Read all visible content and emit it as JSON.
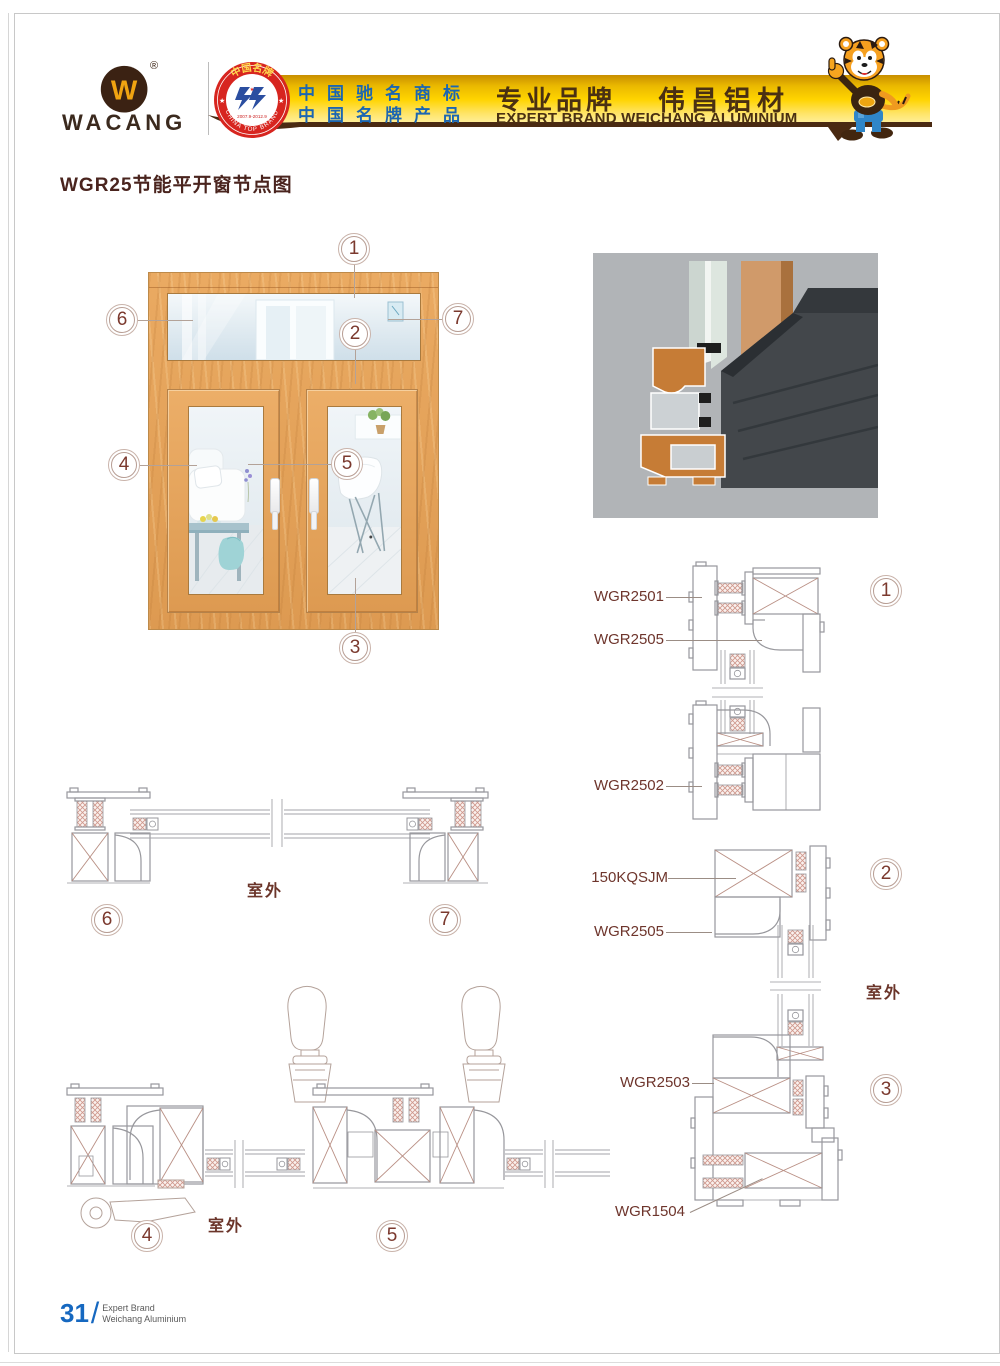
{
  "header": {
    "brand": "WACANG",
    "registered_mark": "®",
    "badge": {
      "arc_top": "中国名牌",
      "arc_bottom": "CHINA TOP BRAND",
      "years": "2007.9-2012.9"
    },
    "banner": {
      "honor_line1": "中国驰名商标",
      "honor_line2": "中国名牌产品",
      "slogan_cn": "专业品牌",
      "brand_cn": "伟昌铝材",
      "slogan_en": "EXPERT BRAND WEICHANG ALUMINIUM"
    }
  },
  "page": {
    "title": "WGR25节能平开窗节点图",
    "number": "31",
    "number_separator": "/",
    "footer_line1": "Expert Brand",
    "footer_line2": "Weichang Aluminium"
  },
  "callouts": [
    "1",
    "2",
    "3",
    "4",
    "5",
    "6",
    "7"
  ],
  "details": {
    "labels": [
      {
        "text": "WGR2501"
      },
      {
        "text": "WGR2505"
      },
      {
        "text": "WGR2502"
      },
      {
        "text": "150KQSJM"
      },
      {
        "text": "WGR2505"
      },
      {
        "text": "WGR2503"
      },
      {
        "text": "WGR1504"
      }
    ],
    "outdoor_right": "室外",
    "outdoor_mid": "室外",
    "outdoor_bottom": "室外"
  },
  "colors": {
    "accent_maroon": "#7b392e",
    "title_brown": "#4a241e",
    "banner_gold": "#ffd103",
    "banner_text_blue": "#1b66b2",
    "banner_text_brown": "#4a3012",
    "badge_red": "#d7251f",
    "page_number_blue": "#1668c0",
    "drawing_gray": "#97979c",
    "hatch_pink": "#cf978c",
    "wood_orange": "#e2a05e"
  }
}
